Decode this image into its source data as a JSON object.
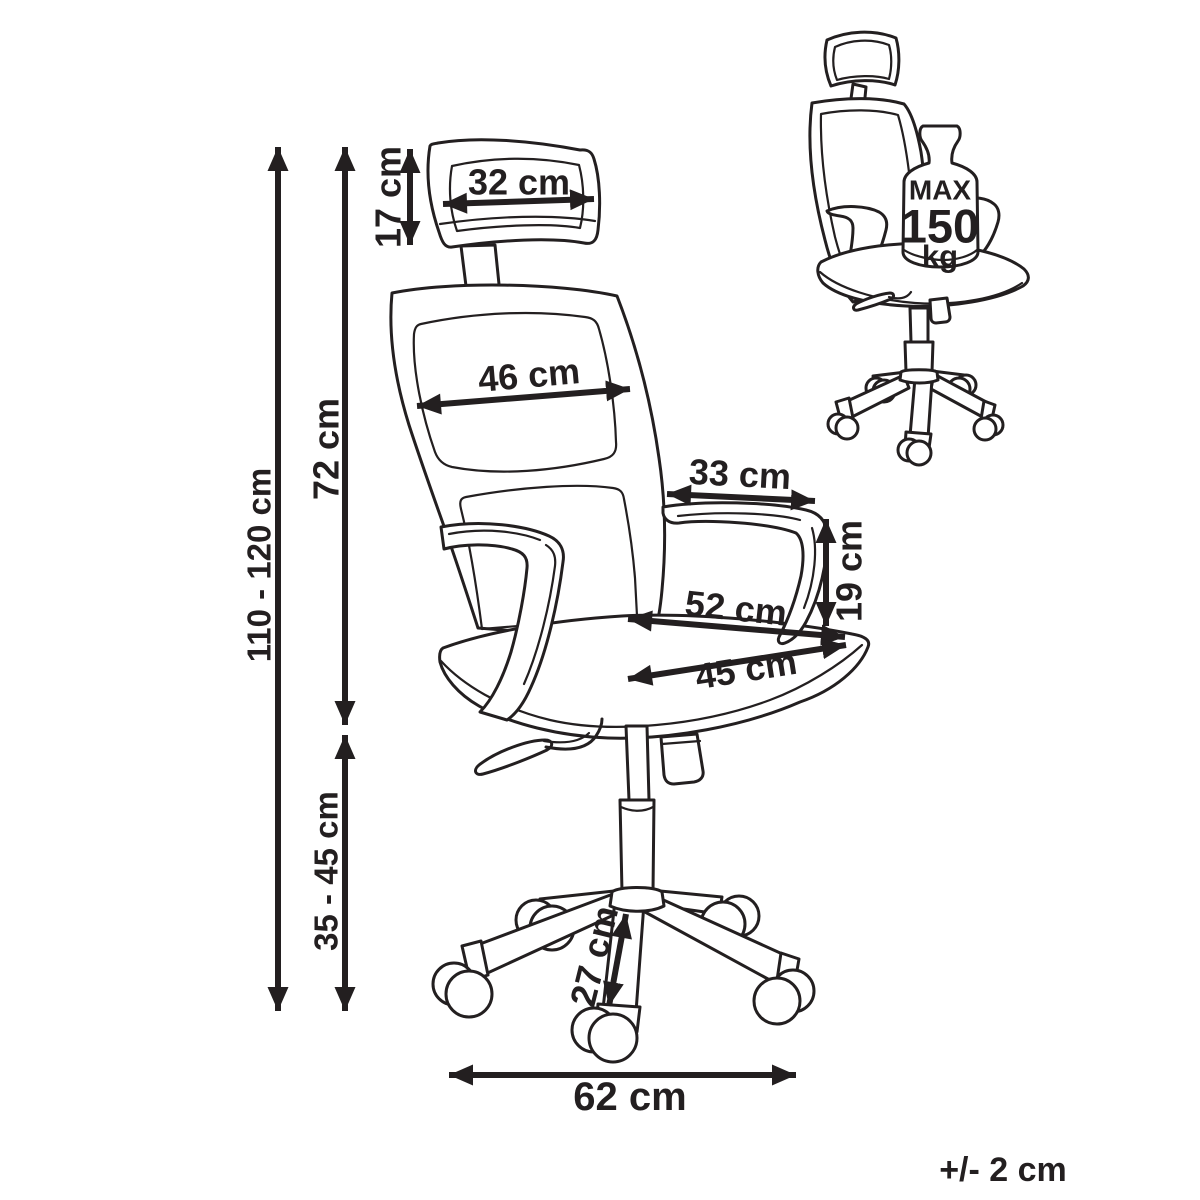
{
  "diagram": {
    "ink_color": "#231f20",
    "background_color": "#ffffff",
    "dimensions": {
      "headrest_width": "32 cm",
      "headrest_height": "17 cm",
      "backrest_width": "46 cm",
      "backrest_height": "72 cm",
      "overall_height": "110 - 120 cm",
      "armrest_length": "33 cm",
      "armrest_height": "19 cm",
      "seat_total_width": "52 cm",
      "seat_width": "45 cm",
      "seat_height": "35 - 45 cm",
      "base_leg_length": "27 cm",
      "base_width": "62 cm"
    },
    "max_load_badge": {
      "line1": "MAX",
      "line2": "150",
      "line3": "kg"
    },
    "tolerance_note": "+/- 2 cm"
  }
}
